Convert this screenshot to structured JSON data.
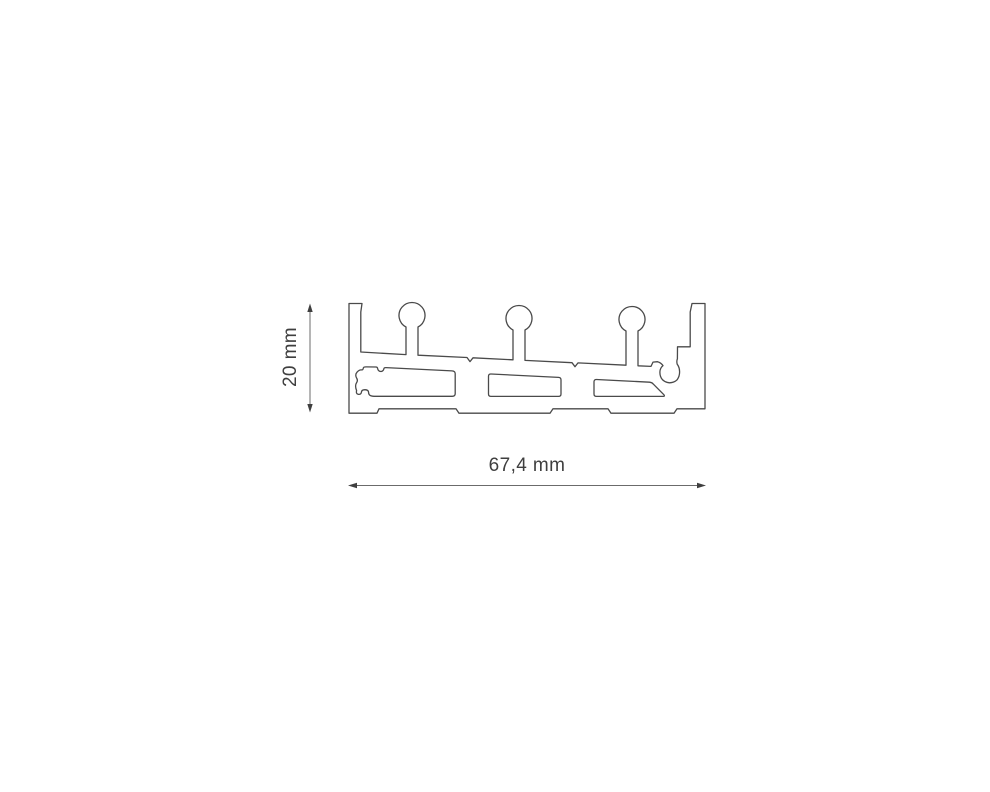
{
  "page": {
    "background": "#ffffff"
  },
  "drawing": {
    "type": "technical-cross-section",
    "description": "Extruded aluminium profile cross-section with three mushroom ribs, internal cavities and screw ports",
    "line_color": "#4a4a4a",
    "dimension_line_color": "#6b6b6b",
    "dimension_arrow_color": "#3f3f3f",
    "text_color": "#3f3f3f",
    "width_dimension": {
      "label": "67,4 mm"
    },
    "height_dimension": {
      "label": "20 mm"
    }
  }
}
